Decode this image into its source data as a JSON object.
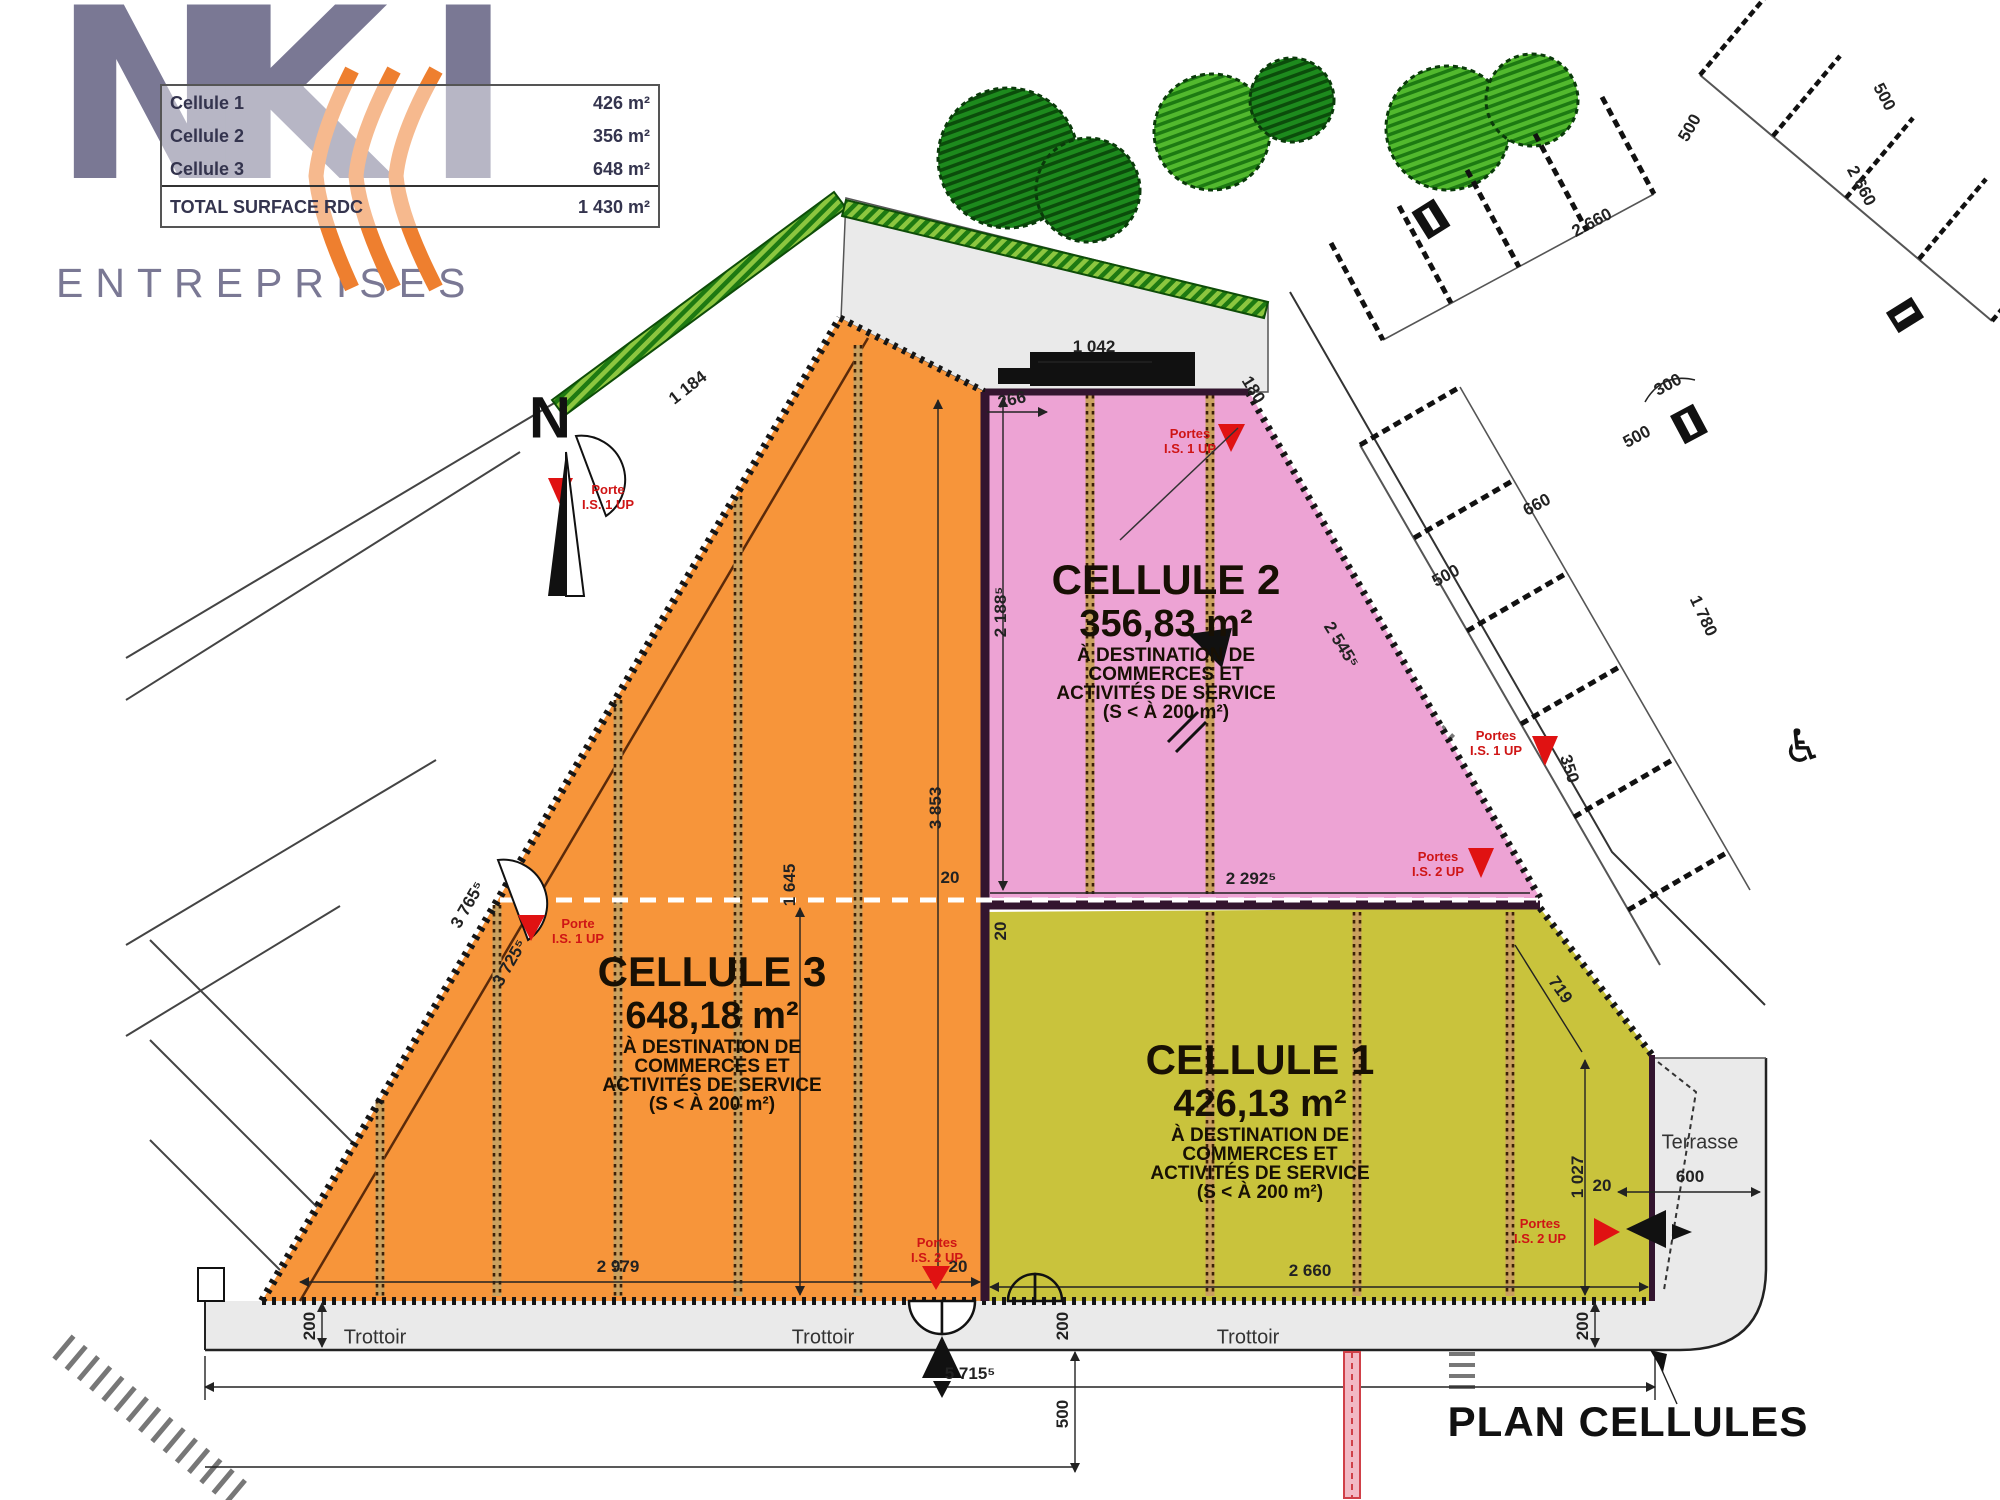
{
  "logo": {
    "n": "N",
    "k": "K",
    "i": "I",
    "subtitle": "ENTREPRISES"
  },
  "surface_table": {
    "rows": [
      {
        "label": "Cellule 1",
        "value": "426 m²"
      },
      {
        "label": "Cellule 2",
        "value": "356 m²"
      },
      {
        "label": "Cellule 3",
        "value": "648 m²"
      }
    ],
    "total": {
      "label": "TOTAL SURFACE RDC",
      "value": "1 430 m²"
    }
  },
  "north": {
    "label": "N"
  },
  "cells": {
    "cellule1": {
      "title": "CELLULE 1",
      "area": "426,13 m²",
      "dest1": "À DESTINATION DE",
      "dest2": "COMMERCES ET",
      "dest3": "ACTIVITÉS DE SERVICE",
      "dest4": "(S < À 200 m²)"
    },
    "cellule2": {
      "title": "CELLULE 2",
      "area": "356,83 m²",
      "dest1": "À DESTINATION DE",
      "dest2": "COMMERCES ET",
      "dest3": "ACTIVITÉS DE SERVICE",
      "dest4": "(S < À 200 m²)"
    },
    "cellule3": {
      "title": "CELLULE 3",
      "area": "648,18 m²",
      "dest1": "À DESTINATION DE",
      "dest2": "COMMERCES ET",
      "dest3": "ACTIVITÉS DE SERVICE",
      "dest4": "(S < À 200 m²)"
    }
  },
  "streets": {
    "trottoir": "Trottoir",
    "terrasse": "Terrasse"
  },
  "title_block": {
    "title": "PLAN CELLULES"
  },
  "doors": {
    "d1": {
      "l1": "Porte",
      "l2": "I.S. 1 UP"
    },
    "d2": {
      "l1": "Porte",
      "l2": "I.S. 1 UP"
    },
    "d3": {
      "l1": "Portes",
      "l2": "I.S. 1 UP"
    },
    "d4": {
      "l1": "Portes",
      "l2": "I.S. 2 UP"
    },
    "d5": {
      "l1": "Portes",
      "l2": "I.S. 1 UP"
    },
    "d6": {
      "l1": "Portes",
      "l2": "I.S. 2 UP"
    },
    "d7": {
      "l1": "Portes",
      "l2": "I.S. 2 UP"
    }
  },
  "dims": {
    "d1042": "1 042",
    "d266": "266",
    "d180": "180",
    "d1184": "1 184",
    "d2188": "2 188⁵",
    "d3853": "3 853",
    "d2292": "2 292⁵",
    "d2545": "2 545⁵",
    "d719": "719",
    "d3765": "3 765⁵",
    "d3725": "3 725⁵",
    "d1645": "1 645",
    "d2979": "2 979",
    "d2660y": "2 660",
    "d5715": "5 715⁵",
    "d200a": "200",
    "d200b": "200",
    "d200c": "200",
    "d500btm": "500",
    "d20a": "20",
    "d20b": "20",
    "d20c": "20",
    "d20d": "20",
    "d1027": "1 027",
    "d600": "600",
    "p2660": "2 660",
    "p500a": "500",
    "p300": "300",
    "p500b": "500",
    "p660": "660",
    "p500c": "500",
    "p350": "350",
    "p1780": "1 780",
    "p500d": "500",
    "p2660b": "2 660"
  },
  "icons": {
    "wheelchair": "♿"
  },
  "colors": {
    "cell1": "#c9c33c",
    "cell2": "#eda3d4",
    "cell3": "#f7953a",
    "logo_purple": "#7a7894",
    "logo_orange": "#ee7f2f",
    "door_red": "#cf1515",
    "sidewalk": "#eaeaea"
  }
}
